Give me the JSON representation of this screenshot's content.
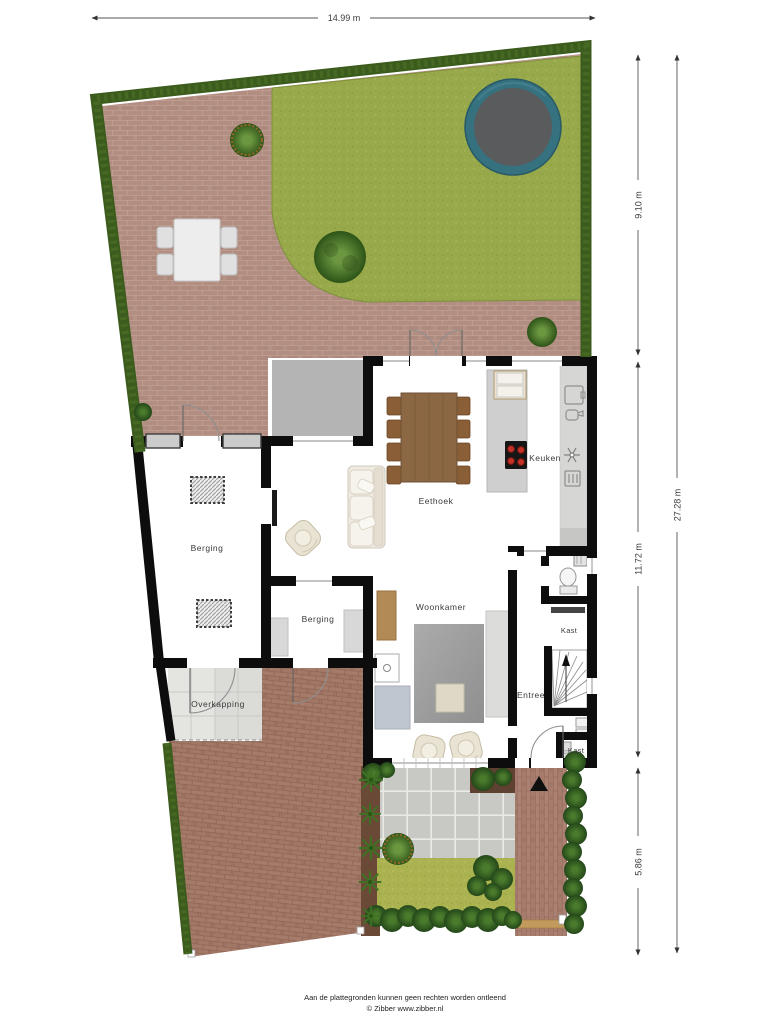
{
  "dimensions": {
    "width_top": "14.99 m",
    "right_inner": [
      "9.10 m",
      "11.72 m",
      "5.86 m"
    ],
    "right_outer": "27.28 m"
  },
  "rooms": {
    "berging_large": "Berging",
    "berging_small": "Berging",
    "eethoek": "Eethoek",
    "keuken": "Keuken",
    "woonkamer": "Woonkamer",
    "entree": "Entree",
    "kast_upper": "Kast",
    "kast_lower": "Kast",
    "overkapping": "Overkapping"
  },
  "footer": {
    "line1": "Aan de plattegronden kunnen geen rechten worden ontleend",
    "line2": "© Zibber www.zibber.nl"
  },
  "colors": {
    "hedge": "#3c5c1e",
    "grass": "#98a94b",
    "patio_brick": "#b18d82",
    "driveway_brick": "#a47a69",
    "walls": "#0d0d0d",
    "trampoline_ring": "#35717f",
    "trampoline_mat": "#595b5d",
    "burner_red": "#c23228"
  }
}
